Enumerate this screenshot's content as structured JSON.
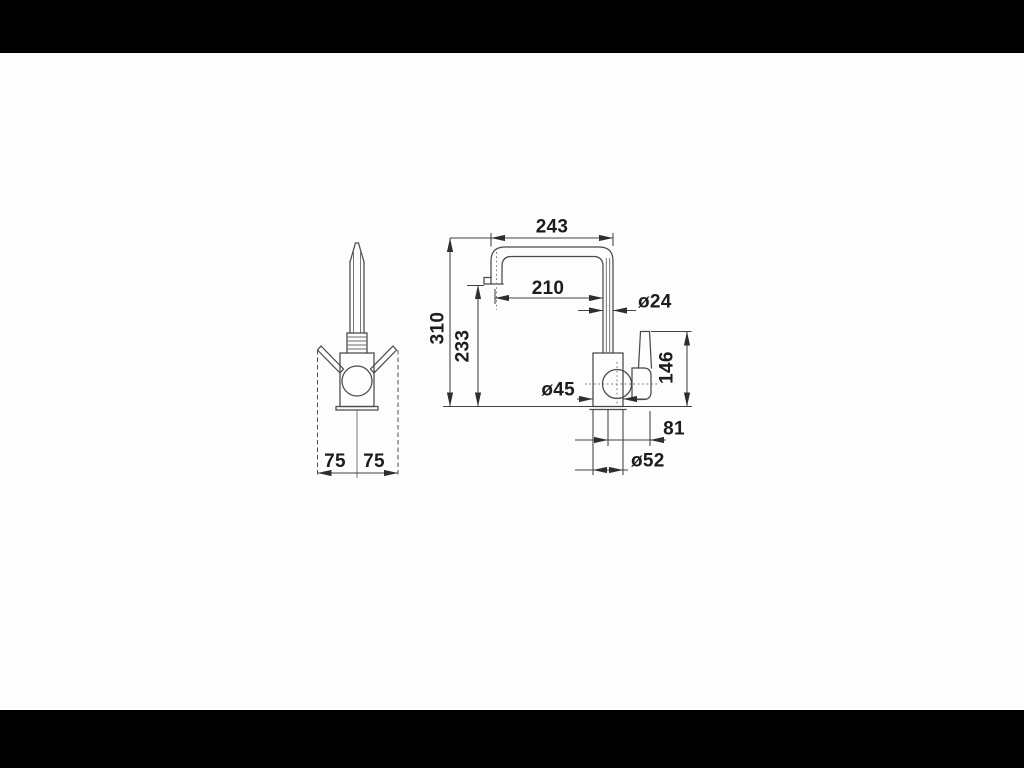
{
  "page": {
    "letterbox_color": "#000000",
    "canvas_color": "#fdfdfd",
    "line_color": "#4a4a4a",
    "dimension_color": "#424242",
    "text_color": "#1c1c1c"
  },
  "drawing": {
    "type": "technical-dimension-diagram",
    "subject": "kitchen mixer tap, two orthographic views with millimetre dimensions",
    "front_view": {
      "dim_swing_left": "75",
      "dim_swing_right": "75"
    },
    "side_view": {
      "dim_spout_reach_overall": "243",
      "dim_spout_reach_outlet": "210",
      "dim_height_overall": "310",
      "dim_height_outlet": "233",
      "dim_spout_tube_diameter": "ø24",
      "dim_handle_top_height": "146",
      "dim_body_diameter": "ø45",
      "dim_handle_offset": "81",
      "dim_base_diameter": "ø52"
    }
  }
}
